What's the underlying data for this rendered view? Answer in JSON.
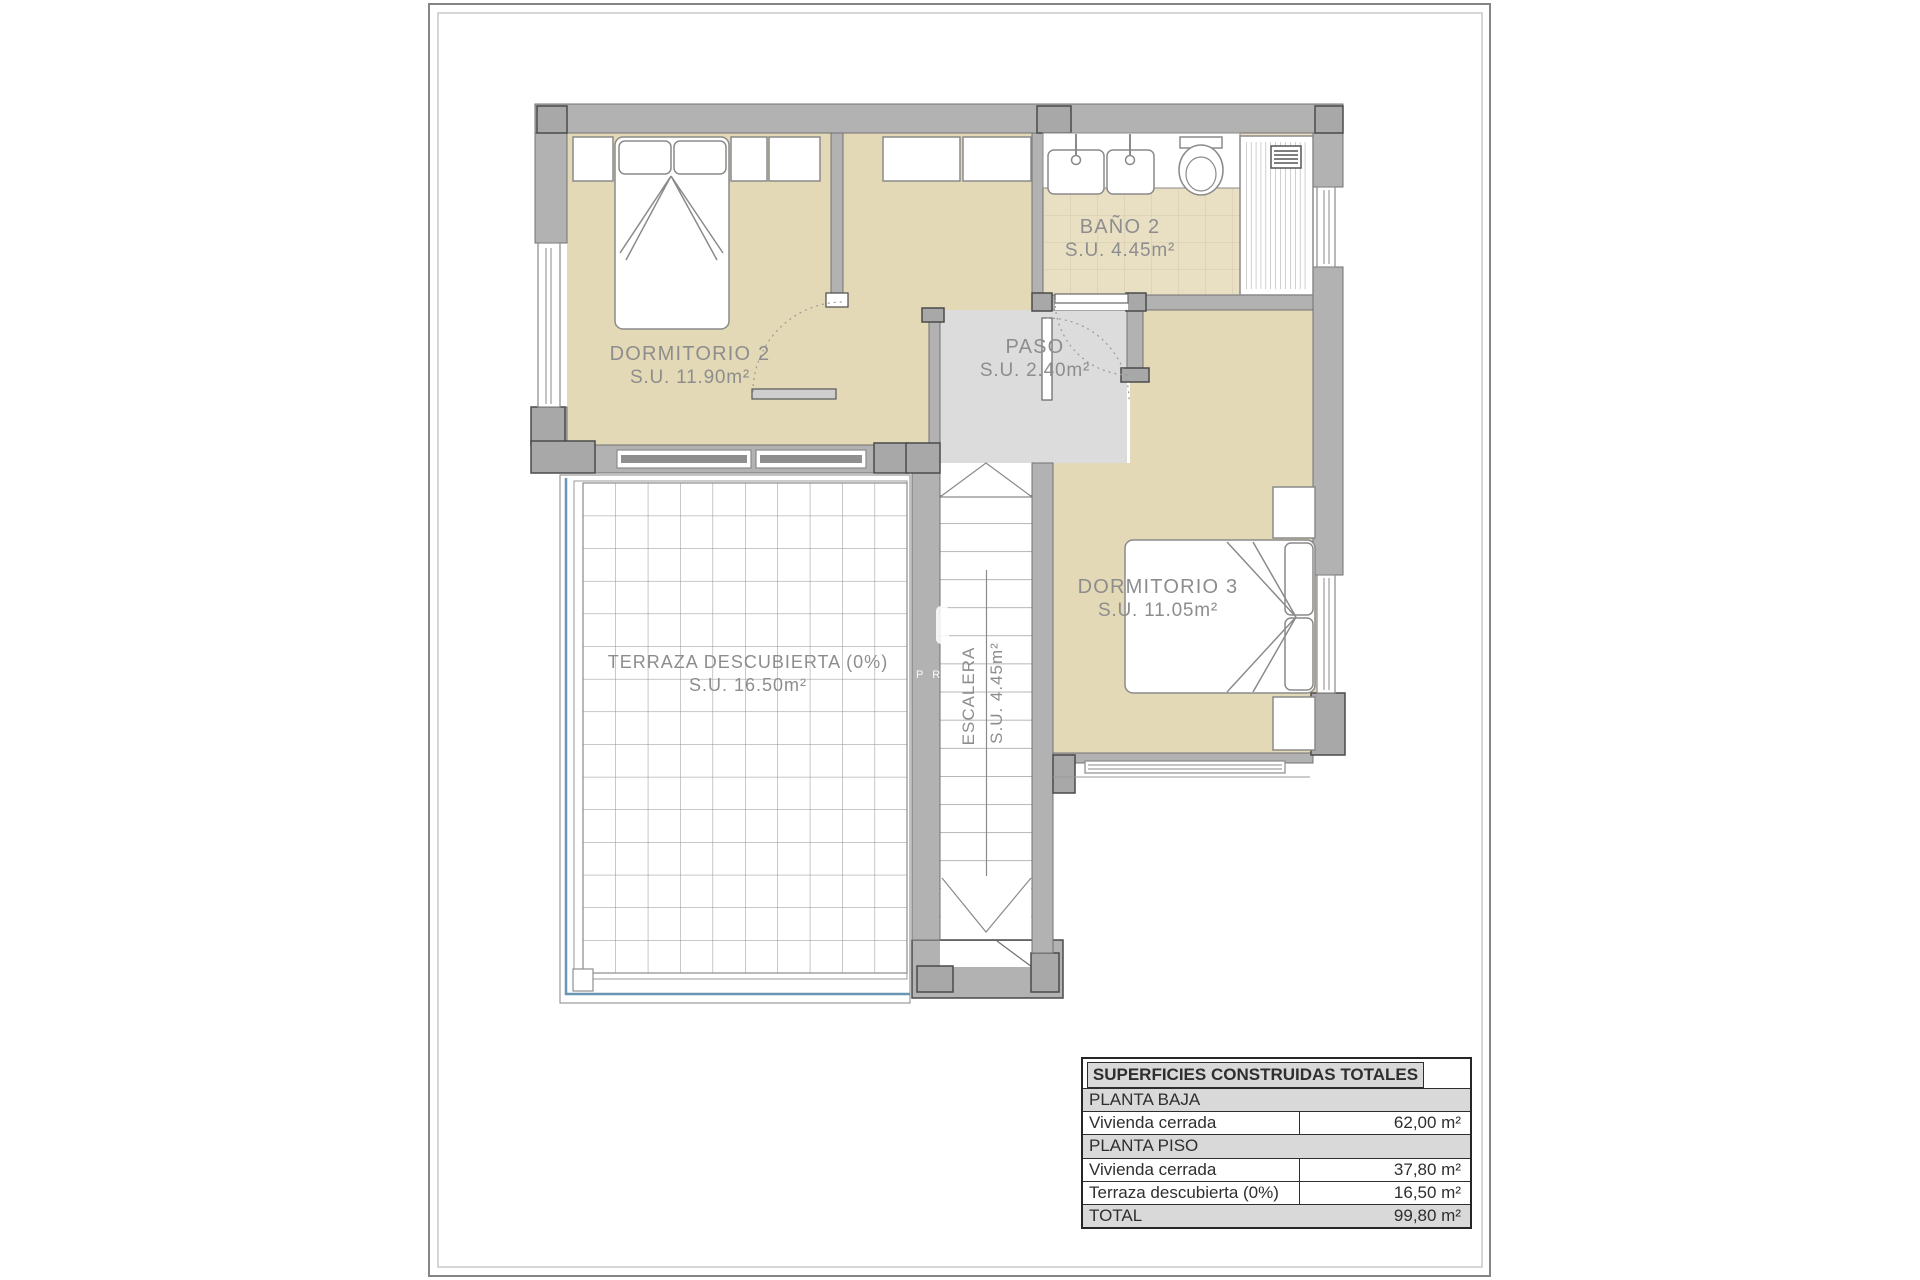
{
  "colors": {
    "room_fill": "#e4d9b6",
    "bath_tile_fill": "#e9e0c4",
    "bath_grout": "#d2c9ae",
    "wall_gray": "#b2b2b2",
    "pilaster_gray": "#a8a8a8",
    "paso_floor": "#dcdcdc",
    "terrace_edge_blue": "#6b95b5",
    "line_gray": "#8a8a8a",
    "label_gray": "#8d8d8d",
    "table_header_bg": "#d9d9d9"
  },
  "rooms": {
    "dormitorio2": {
      "name": "DORMITORIO 2",
      "area": "S.U. 11.90m²"
    },
    "bano2": {
      "name": "BAÑO 2",
      "area": "S.U. 4.45m²"
    },
    "paso": {
      "name": "PASO",
      "area": "S.U. 2.40m²"
    },
    "dormitorio3": {
      "name": "DORMITORIO 3",
      "area": "S.U. 11.05m²"
    },
    "escalera": {
      "name": "ESCALERA",
      "area": "S.U. 4.45m²"
    },
    "terraza": {
      "name": "TERRAZA DESCUBIERTA (0%)",
      "area": "S.U. 16.50m²"
    }
  },
  "watermark": "P R",
  "table": {
    "title": "SUPERFICIES CONSTRUIDAS TOTALES",
    "rows": [
      {
        "label": "PLANTA BAJA",
        "value": ""
      },
      {
        "label": "Vivienda cerrada",
        "value": "62,00 m²"
      },
      {
        "label": "PLANTA PISO",
        "value": ""
      },
      {
        "label": "Vivienda cerrada",
        "value": "37,80 m²"
      },
      {
        "label": "Terraza descubierta (0%)",
        "value": "16,50 m²"
      },
      {
        "label": "TOTAL",
        "value": "99,80 m²"
      }
    ]
  }
}
